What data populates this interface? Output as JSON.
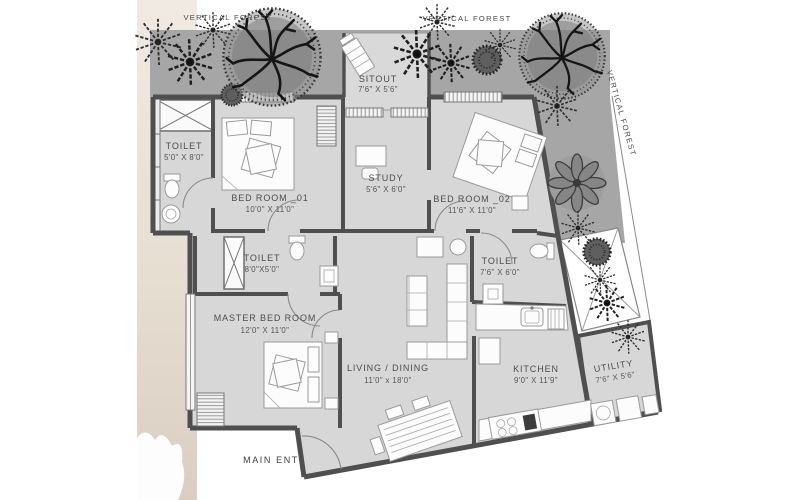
{
  "title": "Apartment Floor Plan",
  "palette": {
    "wall": "#4f4f4f",
    "floor": "#d7d7d7",
    "planter": "#a6a6a6",
    "page_strip": "#e9e1d6",
    "background": "#ffffff",
    "text": "#4c4c4c"
  },
  "labels": {
    "vertical_forest_top_left": "VERTICAL FOREST",
    "vertical_forest_top_right": "VERTICAL FOREST",
    "vertical_forest_right": "VERTICAL FOREST",
    "main_entrance": "MAIN ENT"
  },
  "rooms": [
    {
      "id": "toilet_1",
      "name": "TOILET",
      "dims": "5'0\" X 8'0\""
    },
    {
      "id": "bedroom_1",
      "name": "BED ROOM _01",
      "dims": "10'0\" X 11'0\""
    },
    {
      "id": "sitout",
      "name": "SITOUT",
      "dims": "7'6\" X 5'6\""
    },
    {
      "id": "study",
      "name": "STUDY",
      "dims": "5'6\" X 6'0\""
    },
    {
      "id": "bedroom_2",
      "name": "BED ROOM _02",
      "dims": "11'6\" X 11'0\""
    },
    {
      "id": "toilet_2",
      "name": "TOILET",
      "dims": "8'0\"X5'0\""
    },
    {
      "id": "toilet_3",
      "name": "TOILET",
      "dims": "7'6\" X 6'0\""
    },
    {
      "id": "master_bedroom",
      "name": "MASTER BED ROOM",
      "dims": "12'0\" X 11'0\""
    },
    {
      "id": "living_dining",
      "name": "LIVING / DINING",
      "dims": "11'0\" x 18'0\""
    },
    {
      "id": "kitchen",
      "name": "KITCHEN",
      "dims": "9'0\" X 11'9\""
    },
    {
      "id": "utility",
      "name": "UTILITY",
      "dims": "7'6\" X 5'6\""
    }
  ]
}
